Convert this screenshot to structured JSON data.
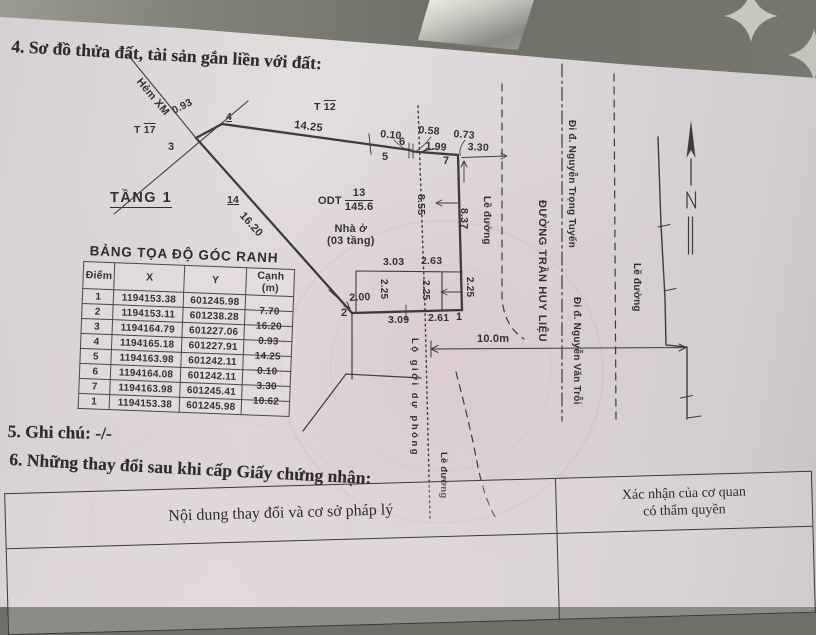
{
  "document": {
    "section4_title": "4. Sơ đồ thửa đất, tài sản gắn liền với đất:",
    "section5_note": "5. Ghi chú: -/-",
    "section6_title": "6. Những thay đổi sau khi cấp Giấy chứng nhận:"
  },
  "diagram": {
    "alley_label": "Hẻm XM",
    "floor_label": "TẦNG 1",
    "land_use_code": "ODT",
    "parcel_number": "13",
    "parcel_area": "145.6",
    "house_line1": "Nhà ở",
    "house_line2": "(03 tầng)",
    "adjacent": {
      "t17_prefix": "T",
      "t17_num": "17",
      "t12_prefix": "T",
      "t12_num": "12",
      "p4_num": "4",
      "p14_num": "14"
    },
    "points": {
      "p1": "1",
      "p2": "2",
      "p3": "3",
      "p5": "5",
      "p6": "6",
      "p7": "7"
    },
    "dims": {
      "d093": "0.93",
      "d1425": "14.25",
      "d010": "0.10",
      "d058": "0.58",
      "d073": "0.73",
      "d199": "1.99",
      "d330": "3.30",
      "d1620": "16.20",
      "d855": "8.55",
      "d837": "8.37",
      "d303": "3.03",
      "d263": "2.63",
      "d225a": "2.25",
      "d225b": "2.25",
      "d225c": "2.25",
      "d200": "2.00",
      "d309": "3.09",
      "d261": "2.61",
      "d10m": "10.0m"
    },
    "streets": {
      "main_road": "ĐƯỜNG TRẦN HUY LIỆU",
      "dir_north": "Đi đ. Nguyễn Trọng Tuyến",
      "dir_south": "Đi đ. Nguyễn Văn Trỗi",
      "roadside1": "Lề đường",
      "roadside2": "Lề đường",
      "roadside3": "Lề đường",
      "planned_boundary": "Lộ giới dự phóng"
    }
  },
  "coord_table": {
    "title": "BẢNG TỌA ĐỘ GÓC RANH",
    "headers": [
      "Điểm",
      "X",
      "Y",
      "Cạnh (m)"
    ],
    "rows": [
      [
        "1",
        "1194153.38",
        "601245.98",
        ""
      ],
      [
        "2",
        "1194153.11",
        "601238.28",
        "7.70"
      ],
      [
        "3",
        "1194164.79",
        "601227.06",
        "16.20"
      ],
      [
        "4",
        "1194165.18",
        "601227.91",
        "0.93"
      ],
      [
        "5",
        "1194163.98",
        "601242.11",
        "14.25"
      ],
      [
        "6",
        "1194164.08",
        "601242.11",
        "0.10"
      ],
      [
        "7",
        "1194163.98",
        "601245.41",
        "3.30"
      ],
      [
        "1",
        "1194153.38",
        "601245.98",
        "10.62"
      ]
    ]
  },
  "changes_table": {
    "col1_header": "Nội dung thay đổi và cơ sở pháp lý",
    "col2_header_line1": "Xác nhận của cơ quan",
    "col2_header_line2": "có thẩm quyền"
  }
}
